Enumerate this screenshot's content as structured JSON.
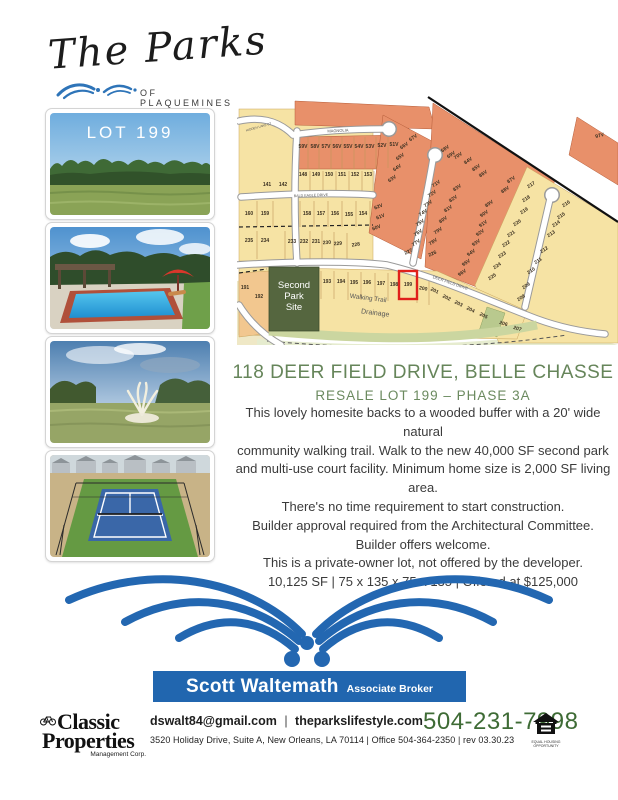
{
  "logo": {
    "script": "The Parks",
    "sub": "OF PLAQUEMINES"
  },
  "photos": {
    "lot_label": "LOT 199"
  },
  "map": {
    "highlight_lot": "199",
    "park_lines": [
      "Second",
      "Park",
      "Site"
    ],
    "street_labels": [
      {
        "t": "MAGNOLIA",
        "x": 101,
        "y": 37,
        "r": -3,
        "s": 4
      },
      {
        "t": "HIDDEN LAKE CT",
        "x": 22,
        "y": 33,
        "r": -16,
        "s": 3.2
      },
      {
        "t": "BALD EAGLE DRIVE",
        "x": 74,
        "y": 101.5,
        "r": -2,
        "s": 3.6
      },
      {
        "t": "DEER FIELD DRIVE",
        "x": 213,
        "y": 189,
        "r": 19,
        "s": 4
      },
      {
        "t": "Walking Trail",
        "x": 131,
        "y": 205,
        "r": 7,
        "s": 6.5,
        "c": "#3c3c3c"
      },
      {
        "t": "Drainage",
        "x": 138,
        "y": 220,
        "r": 7,
        "s": 7,
        "c": "#4c4c4c"
      }
    ],
    "lots": [
      {
        "t": "141",
        "x": 30,
        "y": 91
      },
      {
        "t": "142",
        "x": 46,
        "y": 91
      },
      {
        "t": "59V",
        "x": 66,
        "y": 53
      },
      {
        "t": "58V",
        "x": 78,
        "y": 53
      },
      {
        "t": "57V",
        "x": 89,
        "y": 53
      },
      {
        "t": "56V",
        "x": 100,
        "y": 53
      },
      {
        "t": "55V",
        "x": 111,
        "y": 53
      },
      {
        "t": "54V",
        "x": 122,
        "y": 53
      },
      {
        "t": "53V",
        "x": 133,
        "y": 53
      },
      {
        "t": "52V",
        "x": 145,
        "y": 52
      },
      {
        "t": "51V",
        "x": 157,
        "y": 51
      },
      {
        "t": "148",
        "x": 66,
        "y": 81
      },
      {
        "t": "149",
        "x": 79,
        "y": 81
      },
      {
        "t": "150",
        "x": 92,
        "y": 81
      },
      {
        "t": "151",
        "x": 105,
        "y": 81
      },
      {
        "t": "152",
        "x": 118,
        "y": 81
      },
      {
        "t": "153",
        "x": 131,
        "y": 81
      },
      {
        "t": "160",
        "x": 12,
        "y": 120
      },
      {
        "t": "159",
        "x": 28,
        "y": 120
      },
      {
        "t": "158",
        "x": 70,
        "y": 120
      },
      {
        "t": "157",
        "x": 84,
        "y": 120
      },
      {
        "t": "156",
        "x": 98,
        "y": 120
      },
      {
        "t": "155",
        "x": 112,
        "y": 121
      },
      {
        "t": "154",
        "x": 126,
        "y": 120
      },
      {
        "t": "235",
        "x": 12,
        "y": 147
      },
      {
        "t": "234",
        "x": 28,
        "y": 147
      },
      {
        "t": "233",
        "x": 55,
        "y": 148
      },
      {
        "t": "232",
        "x": 67,
        "y": 148
      },
      {
        "t": "231",
        "x": 79,
        "y": 148
      },
      {
        "t": "230",
        "x": 90,
        "y": 149,
        "r": -4
      },
      {
        "t": "229",
        "x": 101,
        "y": 150,
        "r": -4
      },
      {
        "t": "228",
        "x": 119,
        "y": 151,
        "r": -8
      },
      {
        "t": "63V",
        "x": 156,
        "y": 85,
        "r": -34
      },
      {
        "t": "64V",
        "x": 161,
        "y": 74,
        "r": -34
      },
      {
        "t": "65V",
        "x": 164,
        "y": 63,
        "r": -34
      },
      {
        "t": "66V",
        "x": 168,
        "y": 52,
        "r": -34
      },
      {
        "t": "67V",
        "x": 177,
        "y": 44,
        "r": -34
      },
      {
        "t": "62V",
        "x": 142,
        "y": 113,
        "r": -22
      },
      {
        "t": "61V",
        "x": 144,
        "y": 123,
        "r": -22
      },
      {
        "t": "60V",
        "x": 140,
        "y": 134,
        "r": -22
      },
      {
        "t": "71V",
        "x": 200,
        "y": 90,
        "r": -34
      },
      {
        "t": "72V",
        "x": 196,
        "y": 100,
        "r": -34
      },
      {
        "t": "73V",
        "x": 192,
        "y": 110,
        "r": -34
      },
      {
        "t": "74V",
        "x": 187,
        "y": 119,
        "r": -34
      },
      {
        "t": "75V",
        "x": 184,
        "y": 129,
        "r": -34
      },
      {
        "t": "76V",
        "x": 182,
        "y": 139,
        "r": -34
      },
      {
        "t": "77V",
        "x": 180,
        "y": 149,
        "r": -34
      },
      {
        "t": "227",
        "x": 172,
        "y": 158,
        "r": -24
      },
      {
        "t": "83V",
        "x": 221,
        "y": 94,
        "r": -34
      },
      {
        "t": "82V",
        "x": 217,
        "y": 105,
        "r": -34
      },
      {
        "t": "81V",
        "x": 212,
        "y": 115,
        "r": -34
      },
      {
        "t": "80V",
        "x": 207,
        "y": 126,
        "r": -34
      },
      {
        "t": "79V",
        "x": 202,
        "y": 137,
        "r": -34
      },
      {
        "t": "78V",
        "x": 197,
        "y": 148,
        "r": -34
      },
      {
        "t": "226",
        "x": 196,
        "y": 160,
        "r": -24
      },
      {
        "t": "68V",
        "x": 209,
        "y": 55,
        "r": -34
      },
      {
        "t": "69V",
        "x": 215,
        "y": 61,
        "r": -34
      },
      {
        "t": "70V",
        "x": 222,
        "y": 62,
        "r": -34
      },
      {
        "t": "84V",
        "x": 232,
        "y": 67,
        "r": -34
      },
      {
        "t": "85V",
        "x": 240,
        "y": 74,
        "r": -34
      },
      {
        "t": "86V",
        "x": 247,
        "y": 80,
        "r": -34
      },
      {
        "t": "87V",
        "x": 275,
        "y": 86,
        "r": -34
      },
      {
        "t": "88V",
        "x": 269,
        "y": 96,
        "r": -34
      },
      {
        "t": "89V",
        "x": 253,
        "y": 110,
        "r": -34
      },
      {
        "t": "90V",
        "x": 248,
        "y": 120,
        "r": -34
      },
      {
        "t": "91V",
        "x": 247,
        "y": 130,
        "r": -34
      },
      {
        "t": "92V",
        "x": 244,
        "y": 139,
        "r": -34
      },
      {
        "t": "93V",
        "x": 240,
        "y": 149,
        "r": -34
      },
      {
        "t": "94V",
        "x": 235,
        "y": 159,
        "r": -34
      },
      {
        "t": "95V",
        "x": 230,
        "y": 169,
        "r": -34
      },
      {
        "t": "96V",
        "x": 226,
        "y": 179,
        "r": -34
      },
      {
        "t": "97V",
        "x": 363,
        "y": 42,
        "r": -15
      },
      {
        "t": "217",
        "x": 295,
        "y": 91,
        "r": -34
      },
      {
        "t": "218",
        "x": 290,
        "y": 105,
        "r": -34
      },
      {
        "t": "219",
        "x": 288,
        "y": 117,
        "r": -34
      },
      {
        "t": "220",
        "x": 281,
        "y": 129,
        "r": -34
      },
      {
        "t": "221",
        "x": 275,
        "y": 140,
        "r": -34
      },
      {
        "t": "222",
        "x": 270,
        "y": 150,
        "r": -34
      },
      {
        "t": "223",
        "x": 266,
        "y": 161,
        "r": -34
      },
      {
        "t": "224",
        "x": 261,
        "y": 172,
        "r": -34
      },
      {
        "t": "225",
        "x": 256,
        "y": 183,
        "r": -34
      },
      {
        "t": "216",
        "x": 330,
        "y": 110,
        "r": -34
      },
      {
        "t": "215",
        "x": 325,
        "y": 122,
        "r": -34
      },
      {
        "t": "214",
        "x": 320,
        "y": 130,
        "r": -34
      },
      {
        "t": "213",
        "x": 315,
        "y": 140,
        "r": -34
      },
      {
        "t": "212",
        "x": 308,
        "y": 156,
        "r": -34
      },
      {
        "t": "211",
        "x": 302,
        "y": 167,
        "r": -34
      },
      {
        "t": "210",
        "x": 295,
        "y": 177,
        "r": -34
      },
      {
        "t": "209",
        "x": 290,
        "y": 192,
        "r": -34
      },
      {
        "t": "208",
        "x": 285,
        "y": 204,
        "r": -34
      },
      {
        "t": "191",
        "x": 8,
        "y": 194
      },
      {
        "t": "192",
        "x": 22,
        "y": 203
      },
      {
        "t": "193",
        "x": 90,
        "y": 188
      },
      {
        "t": "194",
        "x": 104,
        "y": 188
      },
      {
        "t": "195",
        "x": 117,
        "y": 189
      },
      {
        "t": "196",
        "x": 130,
        "y": 189
      },
      {
        "t": "197",
        "x": 144,
        "y": 190
      },
      {
        "t": "198",
        "x": 157,
        "y": 191
      },
      {
        "t": "199",
        "x": 171,
        "y": 191
      },
      {
        "t": "200",
        "x": 186,
        "y": 195,
        "r": 10
      },
      {
        "t": "201",
        "x": 197,
        "y": 197,
        "r": 26
      },
      {
        "t": "202",
        "x": 209,
        "y": 204,
        "r": 26
      },
      {
        "t": "203",
        "x": 221,
        "y": 210,
        "r": 26
      },
      {
        "t": "204",
        "x": 233,
        "y": 216,
        "r": 26
      },
      {
        "t": "205",
        "x": 246,
        "y": 222,
        "r": 26
      },
      {
        "t": "206",
        "x": 266,
        "y": 230,
        "r": 18
      },
      {
        "t": "207",
        "x": 280,
        "y": 235,
        "r": 18
      }
    ]
  },
  "headline": {
    "title": "118 DEER FIELD DRIVE, BELLE CHASSE",
    "subtitle": "RESALE LOT 199 – PHASE 3A"
  },
  "description": {
    "lines": [
      "This lovely homesite backs to a wooded buffer with a 20' wide natural",
      "community walking trail.  Walk to the new 40,000 SF second park",
      "and multi-use court facility.  Minimum home size is 2,000 SF living area.",
      "There's no time requirement to start construction.",
      "Builder approval required from the Architectural Committee.",
      "Builder offers welcome.",
      "This is a private-owner lot, not offered by the developer.",
      "10,125 SF  | 75 x 135 x 75 x 135  |  Offered at $125,000"
    ]
  },
  "agent": {
    "name": "Scott Waltemath",
    "role": "Associate Broker"
  },
  "brokerage": {
    "name1": "Classic",
    "name2": "Properties",
    "sub": "Management Corp."
  },
  "contact": {
    "email": "dswalt84@gmail.com",
    "separator": "|",
    "website": "theparkslifestyle.com",
    "phone": "504-231-7998",
    "address_line": "3520 Holiday Drive, Suite A, New Orleans, LA 70114  |  Office 504-364-2350  |  rev  03.30.23"
  },
  "equal_housing": {
    "line1": "EQUAL HOUSING",
    "line2": "OPPORTUNITY"
  },
  "colors": {
    "brand_blue": "#2166af",
    "headline_green": "#66855a",
    "phone_green": "#3e6b35",
    "map_tan": "#f6e3a4",
    "map_orange": "#e8906a",
    "map_peach": "#f2c78f",
    "park_green": "#55663f",
    "trail_green": "#cbd6a0",
    "highlight_red": "#e0201b"
  }
}
